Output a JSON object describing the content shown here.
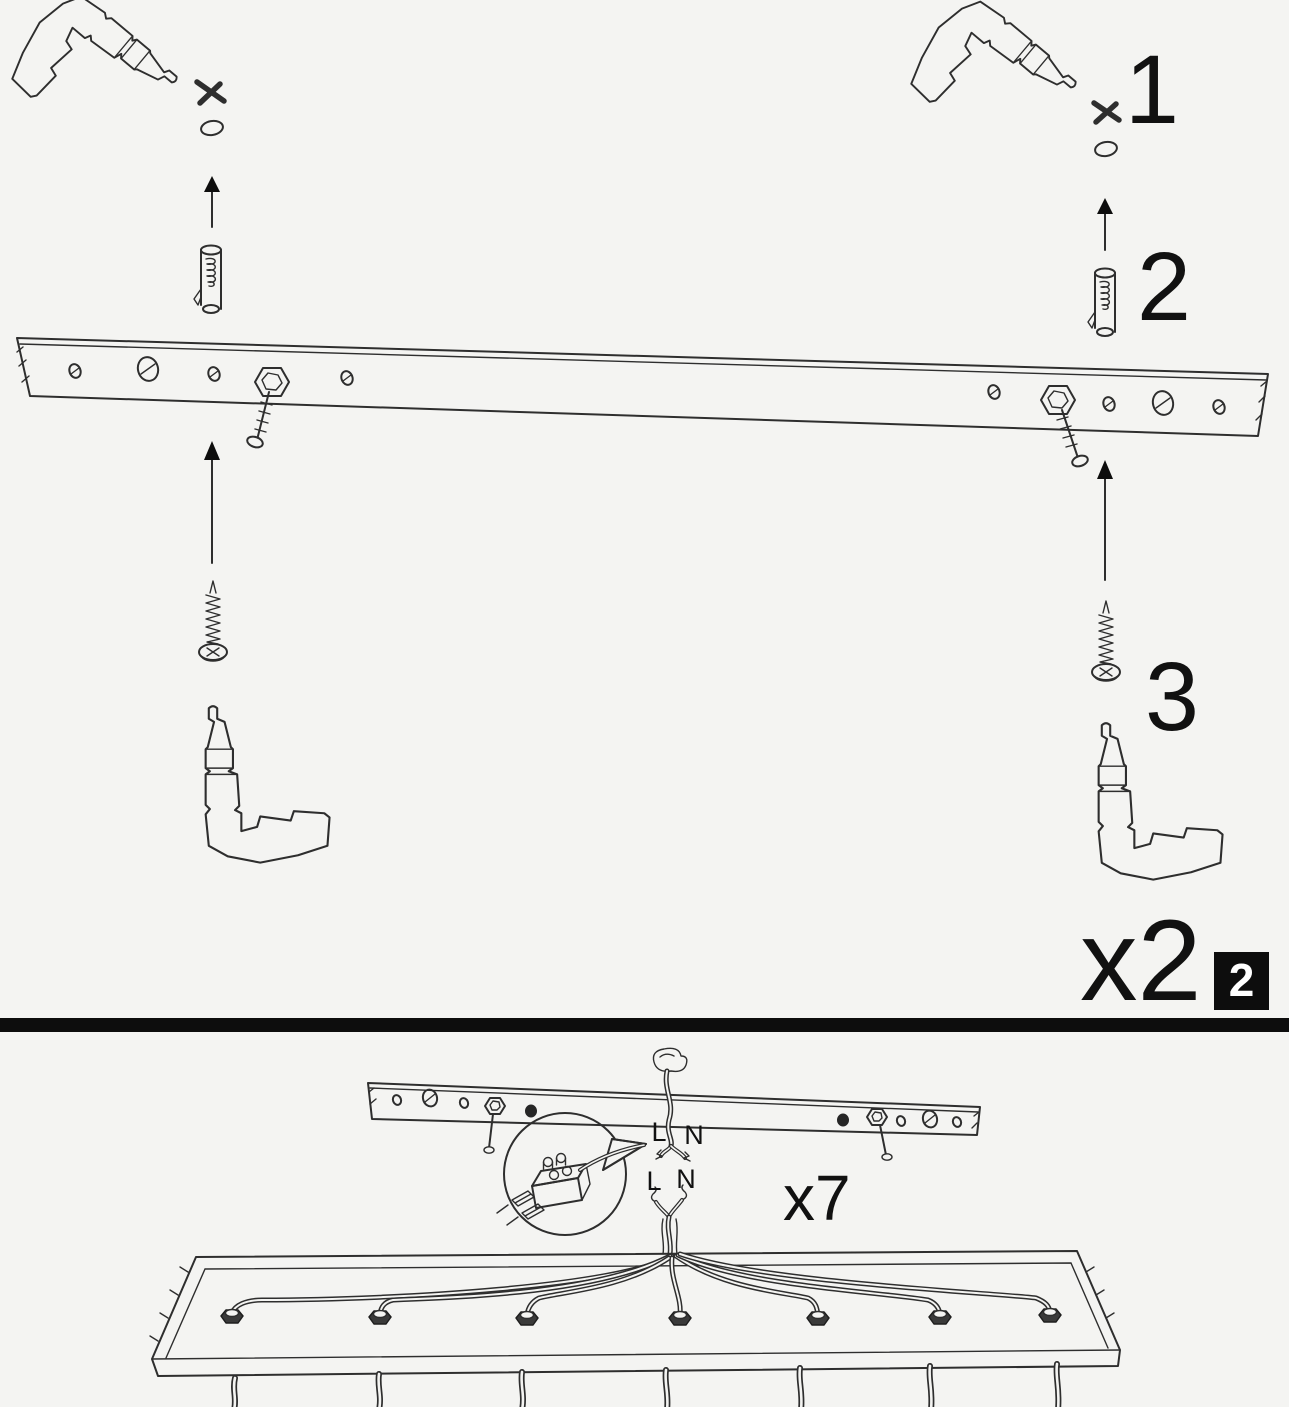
{
  "colors": {
    "background": "#f4f4f2",
    "line": "#2e2e2e",
    "ink": "#0d0d0d",
    "white": "#ffffff"
  },
  "step_panel": {
    "step_1_label": "1",
    "step_2_label": "2",
    "step_3_label": "3",
    "repeat_label": "x2",
    "panel_number": "2"
  },
  "wiring_panel": {
    "repeat_label": "x7",
    "top_live_label": "L",
    "top_neutral_label": "N",
    "bottom_live_label": "L",
    "bottom_neutral_label": "N"
  },
  "icons": [
    "power-drill-icon",
    "drill-point-x-icon",
    "drilled-hole-icon",
    "up-arrow-icon",
    "wall-plug-icon",
    "mounting-bar-icon",
    "hex-bolt-icon",
    "screw-icon",
    "ceiling-cable-icon",
    "terminal-block-icon",
    "magnifier-callout-icon",
    "canopy-icon",
    "cable-gland-icon"
  ]
}
